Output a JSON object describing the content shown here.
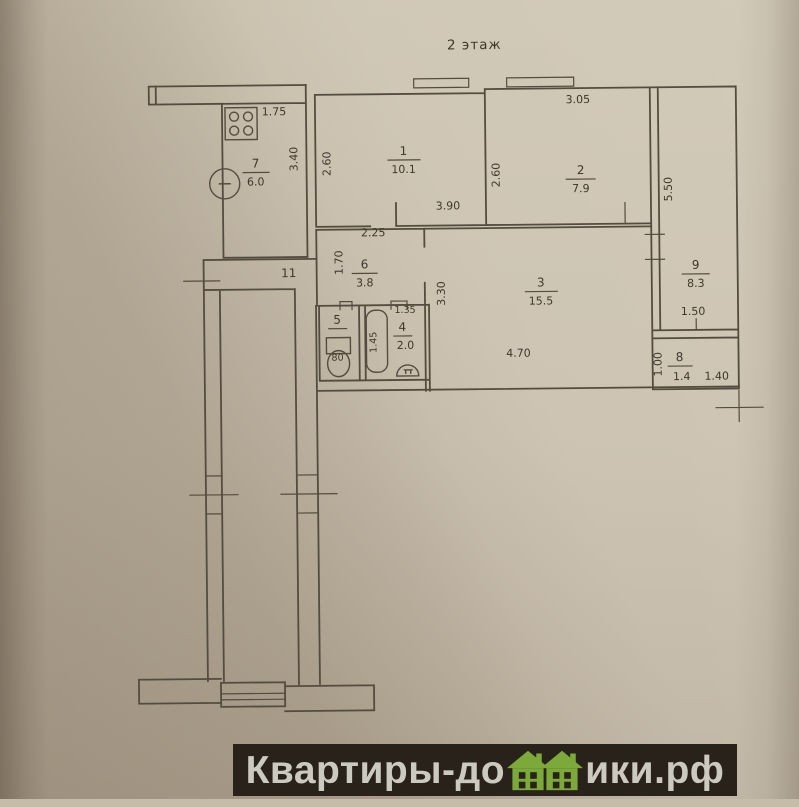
{
  "title": "2 этаж",
  "plan": {
    "rooms": {
      "r1": {
        "num": "1",
        "area": "10.1"
      },
      "r2": {
        "num": "2",
        "area": "7.9"
      },
      "r3": {
        "num": "3",
        "area": "15.5"
      },
      "r4": {
        "num": "4",
        "area": "2.0"
      },
      "r5": {
        "num": "5"
      },
      "r6": {
        "num": "6",
        "area": "3.8"
      },
      "r7": {
        "num": "7",
        "area": "6.0"
      },
      "r8": {
        "num": "8",
        "area": "1.4"
      },
      "r9": {
        "num": "9",
        "area": "8.3"
      },
      "c11": {
        "num": "11"
      }
    },
    "dims": {
      "kitchen_w": "1.75",
      "kitchen_h": "3.40",
      "room1_h": "2.60",
      "room1_w": "3.90",
      "room2_w": "3.05",
      "room2_h": "2.60",
      "loggia_h": "5.50",
      "loggia_w": "1.50",
      "hall_w": "2.25",
      "hall_h": "1.70",
      "room3_h": "3.30",
      "room3_w": "4.70",
      "bath_w": "1.35",
      "bath_h": "1.45",
      "room8_h": "1.00",
      "room8_w": "1.40"
    },
    "fixtures": {
      "toilet_mark": "80"
    }
  },
  "watermark": {
    "text_before": "Квартиры-до",
    "text_after": "ики.рф",
    "house_color": "#7baa3b",
    "bar_color": "#29221a"
  }
}
